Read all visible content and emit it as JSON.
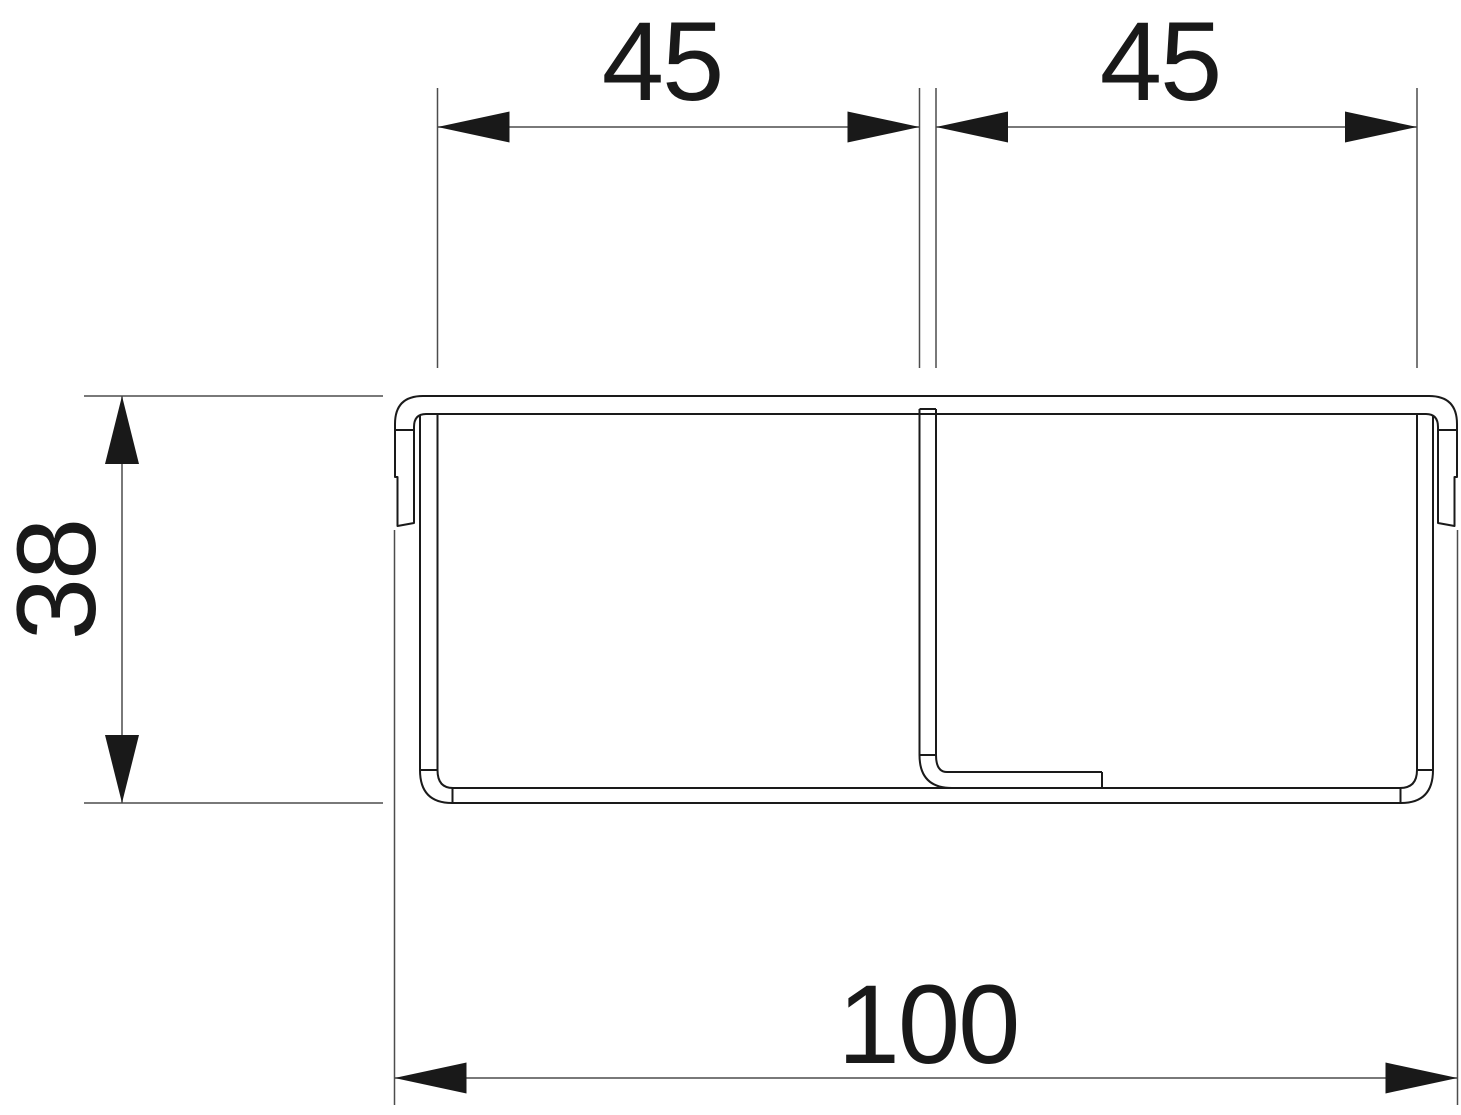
{
  "drawing": {
    "kind": "technical-cross-section",
    "colors": {
      "background": "#ffffff",
      "profile_line": "#1a1a1a",
      "dimension_line": "#4d4d4d",
      "arrow_and_text": "#191919"
    },
    "dimensions": {
      "left_compartment_width": {
        "label": "45",
        "orientation": "horizontal"
      },
      "right_compartment_width": {
        "label": "45",
        "orientation": "horizontal"
      },
      "overall_height": {
        "label": "38",
        "orientation": "vertical"
      },
      "overall_width": {
        "label": "100",
        "orientation": "horizontal"
      }
    }
  }
}
